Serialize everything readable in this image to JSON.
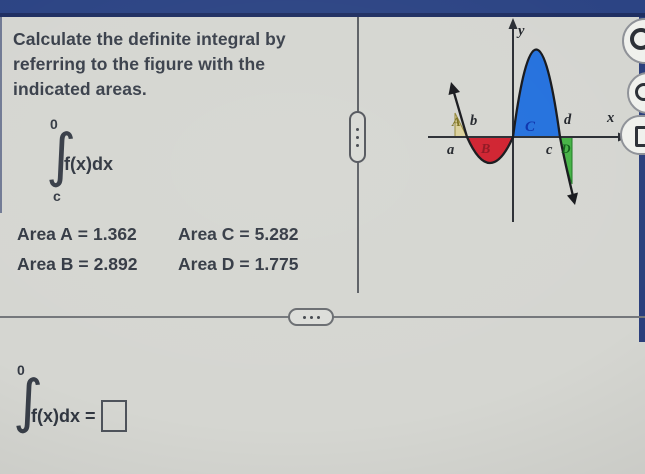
{
  "window": {
    "top_bar_color": "#2c4484",
    "accent_line_color": "#1f2f62",
    "background_color": "#d5d6d1"
  },
  "problem": {
    "statement": "Calculate the definite integral by referring to the figure with the indicated areas.",
    "statement_lines": [
      "Calculate the definite integral by",
      "referring to the figure with the",
      "indicated areas."
    ],
    "integral": {
      "upper_limit": "0",
      "sign": "∫",
      "integrand": "f(x)dx",
      "lower_limit": "c"
    },
    "areas": [
      {
        "label": "Area A",
        "eq": "=",
        "value": "1.362"
      },
      {
        "label": "Area C",
        "eq": "=",
        "value": "5.282"
      },
      {
        "label": "Area B",
        "eq": "=",
        "value": "2.892"
      },
      {
        "label": "Area D",
        "eq": "=",
        "value": "1.775"
      }
    ]
  },
  "figure": {
    "y_axis_label": "y",
    "x_axis_label": "x",
    "tick_labels": {
      "a": "a",
      "b": "b",
      "c": "c",
      "d": "d"
    },
    "regions": [
      {
        "label": "A",
        "color": "#dbd19c",
        "letter_color": "#7c7120",
        "position": "above x-axis between a and b"
      },
      {
        "label": "B",
        "color": "#d0212f",
        "letter_color": "#8f1520",
        "position": "below x-axis between b and 0"
      },
      {
        "label": "C",
        "color": "#2471dd",
        "letter_color": "#0c33ad",
        "position": "above x-axis between 0 and c"
      },
      {
        "label": "D",
        "color": "#46b346",
        "letter_color": "#0f5c17",
        "position": "below x-axis between c and d"
      }
    ]
  },
  "answer": {
    "upper_limit": "0",
    "sign": "∫",
    "integrand": "f(x)dx",
    "equals": "=",
    "value": ""
  },
  "icons": {
    "pane_splitter": "vertical-dots",
    "section_expander": "horizontal-dots",
    "side_buttons": [
      "ring-icon",
      "ring-icon",
      "square-outline-icon"
    ]
  }
}
